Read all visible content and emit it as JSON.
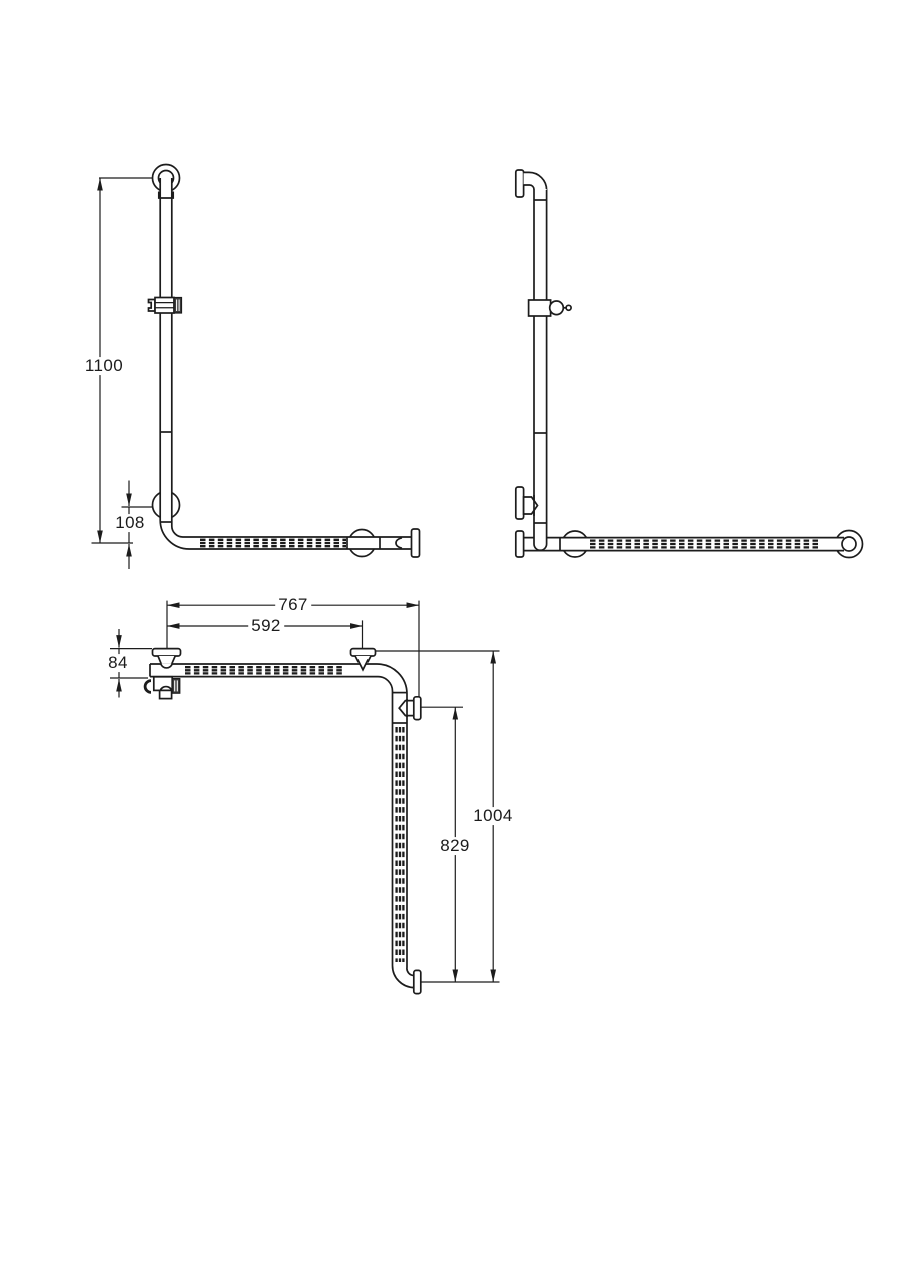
{
  "drawing": {
    "background": "#ffffff",
    "line_color": "#1c1c1c",
    "views": {
      "front_elevation": {
        "dimensions": {
          "overall_height": "1100",
          "corner_offset": "108"
        }
      },
      "side_elevation": {
        "dimensions": {}
      },
      "top_plan": {
        "dimensions": {
          "overall_length": "767",
          "fixing_centres": "592",
          "wall_clearance": "84",
          "grip_section": "829",
          "overall_depth": "1004"
        }
      }
    }
  }
}
